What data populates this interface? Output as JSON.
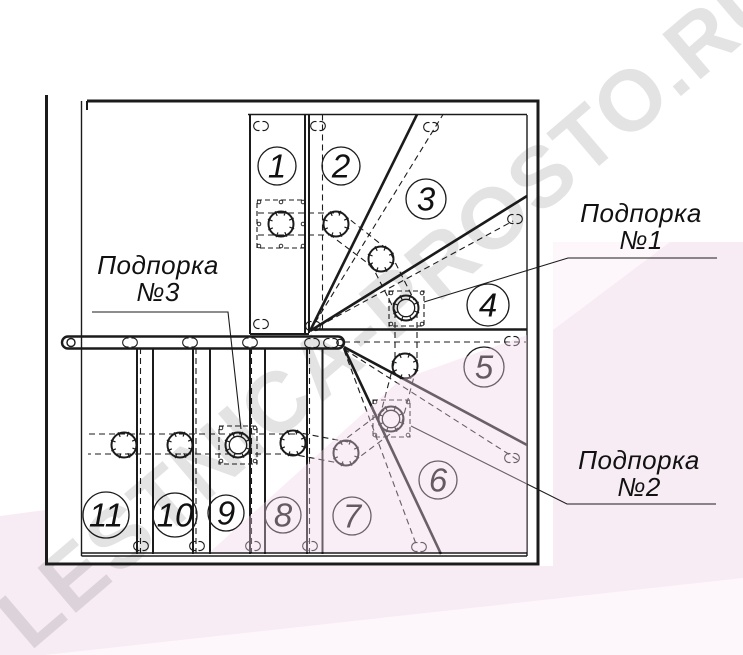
{
  "watermark": {
    "text": "LESTNICA-PROSTO.RU"
  },
  "colors": {
    "ink": "#1b1b1b",
    "pink": "#f8ecf4",
    "pink_light": "#fdf7fb",
    "wash": "rgba(242,211,231,0.38)",
    "label_ink": "#111111"
  },
  "plan": {
    "steps": [
      {
        "label": "1"
      },
      {
        "label": "2"
      },
      {
        "label": "3"
      },
      {
        "label": "4"
      },
      {
        "label": "5"
      },
      {
        "label": "6"
      },
      {
        "label": "7"
      },
      {
        "label": "8"
      },
      {
        "label": "9"
      },
      {
        "label": "10"
      },
      {
        "label": "11"
      }
    ],
    "supports": [
      {
        "line1": "Подпорка",
        "line2": "№1"
      },
      {
        "line1": "Подпорка",
        "line2": "№2"
      },
      {
        "line1": "Подпорка",
        "line2": "№3"
      }
    ]
  }
}
